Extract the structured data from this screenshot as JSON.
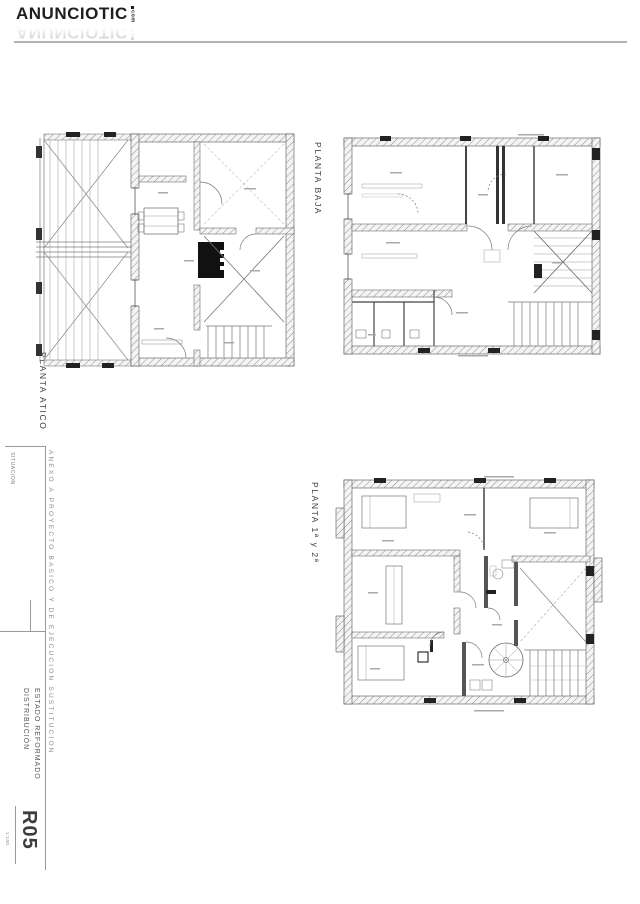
{
  "logo": {
    "brand": "ANUNCIOTIC",
    "tld": "com"
  },
  "plans": [
    {
      "id": "atico",
      "label": "PLANTA ATICO"
    },
    {
      "id": "baja",
      "label": "PLANTA BAJA"
    },
    {
      "id": "p12",
      "label": "PLANTA 1ª y 2ª"
    }
  ],
  "titleblock": {
    "situacion": "SITUACION",
    "side_note": "ANEXO A PROYECTO BASICO Y DE EJECUCION SUSTITUCION",
    "estado_line1": "ESTADO REFORMADO",
    "estado_line2": "DISTRIBUCIÓN",
    "sheet_code": "R05",
    "scale": "1:100"
  },
  "colors": {
    "ink": "#3a3a3a",
    "wall_hatch": "#8f8f8f",
    "light_line": "#9a9a9a",
    "core_fill": "#111111"
  }
}
